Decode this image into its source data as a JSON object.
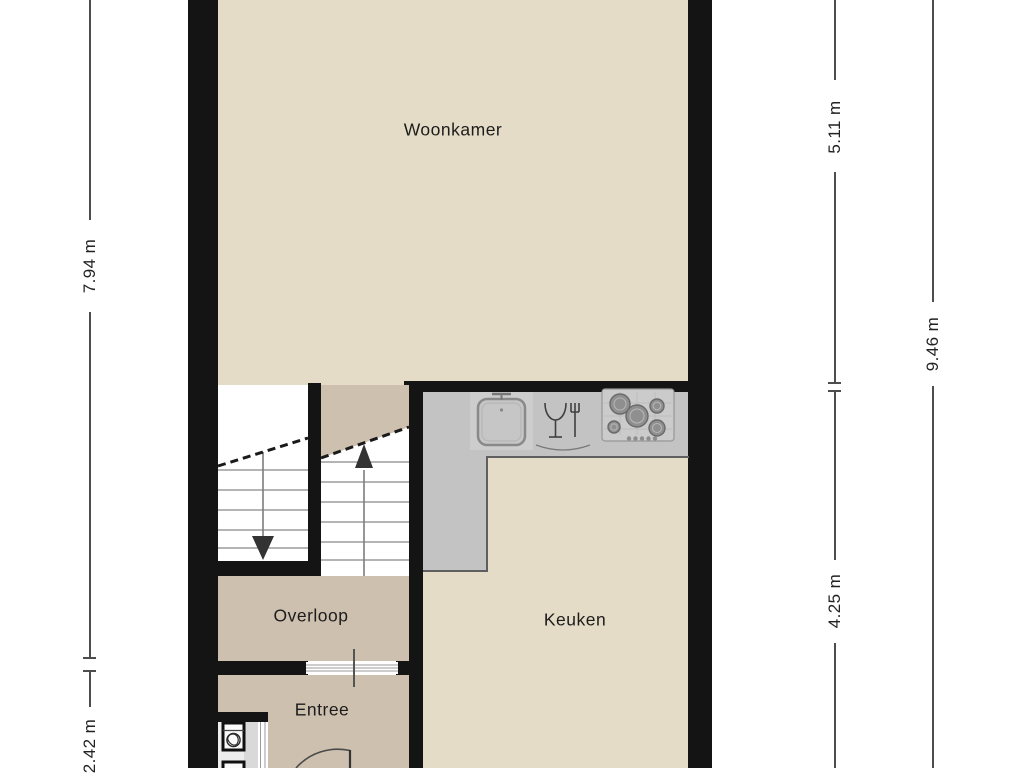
{
  "page": {
    "type": "floor-plan",
    "background": "#ffffff"
  },
  "rooms": [
    {
      "id": "woonkamer",
      "label": "Woonkamer"
    },
    {
      "id": "overloop",
      "label": "Overloop"
    },
    {
      "id": "keuken",
      "label": "Keuken"
    },
    {
      "id": "entree",
      "label": "Entree"
    }
  ],
  "dimensions": [
    {
      "id": "left-upper",
      "side": "left",
      "label": "7.94 m"
    },
    {
      "id": "left-lower",
      "side": "left",
      "label": "2.42 m"
    },
    {
      "id": "right-inner-upper",
      "side": "right",
      "label": "5.11 m"
    },
    {
      "id": "right-inner-lower",
      "side": "right",
      "label": "4.25 m"
    },
    {
      "id": "right-outer",
      "side": "right",
      "label": "9.46 m"
    }
  ],
  "icons": [
    "sink-icon",
    "dishwasher-icon",
    "gas-hob-icon",
    "toilet-icon",
    "washbasin-icon",
    "stairs-up-arrow-icon",
    "stairs-down-arrow-icon",
    "door-swing-icon"
  ],
  "colors": {
    "floor_light": "#e4dcc6",
    "floor_dark": "#cec0af",
    "wall": "#141414",
    "counter": "#c3c3c3",
    "counter_light": "#cdcdcd",
    "stair_tread": "#9b9b9b",
    "dimension_line": "#4d4d4d",
    "label_text": "#1c1c1c"
  }
}
